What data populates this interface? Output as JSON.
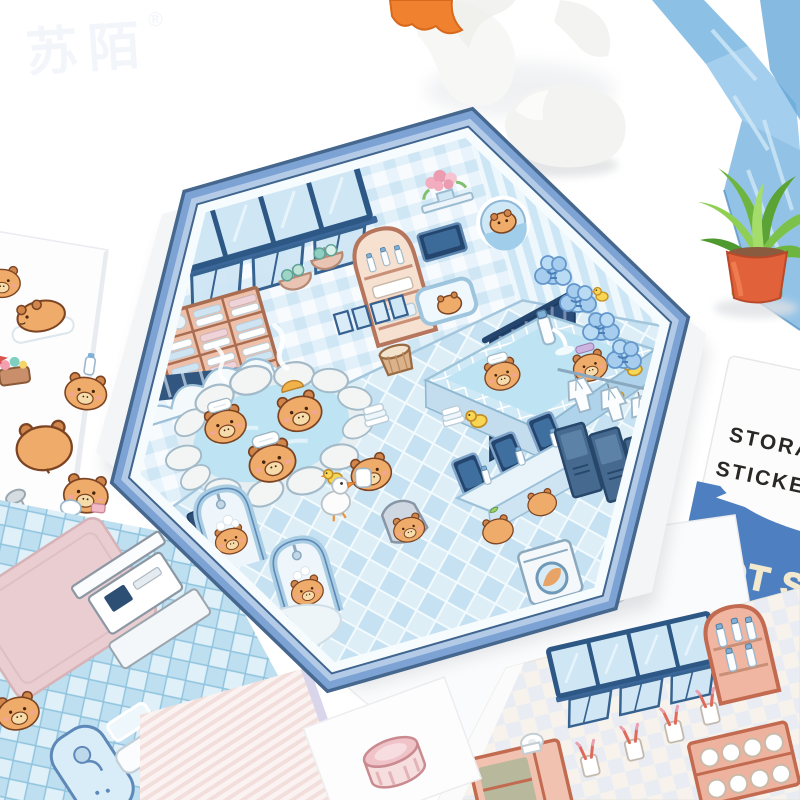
{
  "watermark": {
    "text": "苏陌",
    "registered_mark": "®"
  },
  "right_card": {
    "heading_line1": "STORAGE",
    "heading_line2": "STICKER SE",
    "banner_line1": "HOT SP",
    "banner_line2": "CHAPTE",
    "heading_color": "#2a2825",
    "banner_bg": "#4e80c1",
    "banner_text_color": "#f2e9cf"
  },
  "hex_board": {
    "sign_text": "汤泉乐园",
    "border_color": "#7da2d4",
    "border_edge_color": "#46688f",
    "border_inner_band": "#b3cbe7",
    "wall_tile_color": "#cfe6f4",
    "floor_tile_color": "#c6e2f2",
    "curtain_color": "#2b4d7c",
    "water_color": "#bee4f3",
    "capybara_color": "#eeab69",
    "duck_color": "#f8d653",
    "wood_color": "#e2a893"
  },
  "props": {
    "plant_pot_color": "#e0613a",
    "plant_leaf_color": "#79bd4a",
    "ribbon_color": "#6fb0de",
    "plush_frill_color": "#f0822f"
  }
}
